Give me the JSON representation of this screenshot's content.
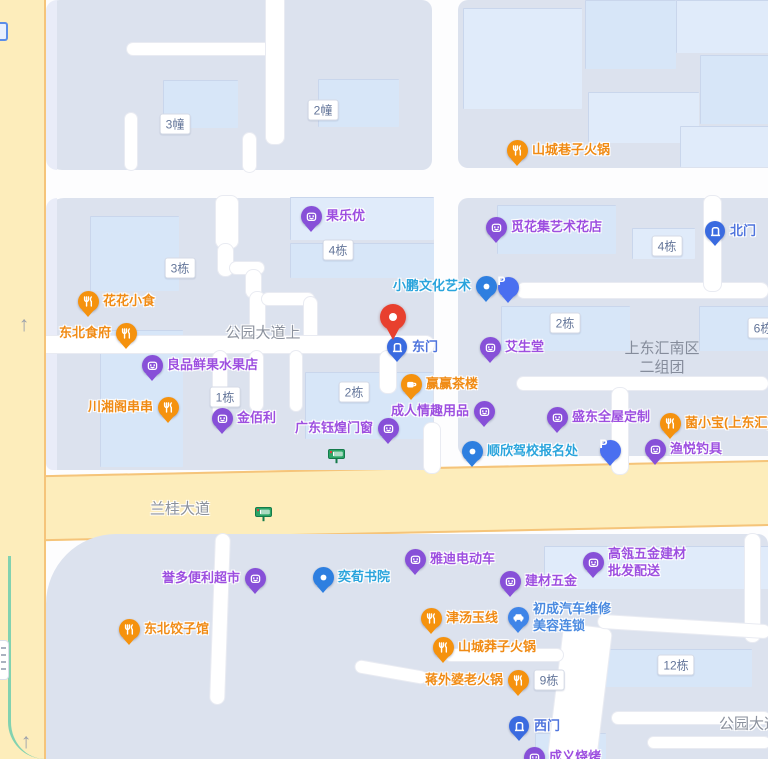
{
  "map": {
    "colors": {
      "poi_purple": "#8750d8",
      "poi_orange": "#f5920e",
      "poi_blue_dot": "#2e7fe0",
      "parking_blue": "#4a6ff0",
      "gate_blue": "#3a6be0",
      "selected_pin_red": "#e8402e",
      "road_yellow": "#fdedbb",
      "road_yellow_border": "#f5c47a",
      "block_gray": "#dce2ee",
      "building_blue": "#d7e6f8",
      "bus_stop_green": "#2ba567"
    },
    "pois": [
      {
        "id": "shancheng-xiangzi-hotpot",
        "type": "orange",
        "icon": "fork-knife-icon",
        "x": 517,
        "y": 150,
        "lines": [
          "山城巷子火锅"
        ],
        "side": "right",
        "lc": "orange"
      },
      {
        "id": "guoleyou",
        "type": "purple",
        "icon": "bag-icon",
        "x": 311,
        "y": 216,
        "lines": [
          "果乐优"
        ],
        "side": "right",
        "lc": "purple"
      },
      {
        "id": "mihuaji-art-flower-shop",
        "type": "purple",
        "icon": "bag-icon",
        "x": 496,
        "y": 227,
        "lines": [
          "觅花集艺术花店"
        ],
        "side": "right",
        "lc": "purple"
      },
      {
        "id": "north-gate",
        "type": "gate",
        "icon": "door-icon",
        "x": 715,
        "y": 231,
        "lines": [
          "北门"
        ],
        "side": "right",
        "lc": "gate"
      },
      {
        "id": "huahua-snack",
        "type": "orange",
        "icon": "fork-knife-icon",
        "x": 88,
        "y": 301,
        "lines": [
          "花花小食"
        ],
        "side": "right",
        "lc": "orange"
      },
      {
        "id": "dongbei-shifu",
        "type": "orange",
        "icon": "fork-knife-icon",
        "x": 126,
        "y": 333,
        "lines": [
          "东北食府"
        ],
        "side": "left",
        "lc": "orange"
      },
      {
        "id": "xiaopeng-culture-art",
        "type": "bluedot",
        "icon": "dot-icon",
        "x": 486,
        "y": 286,
        "lines": [
          "小鹏文化艺术"
        ],
        "side": "left",
        "lc": "cyan"
      },
      {
        "id": "parking-north",
        "type": "parking",
        "icon": "p-letter-icon",
        "x": 508,
        "y": 287,
        "lines": [],
        "side": "right",
        "lc": "purple"
      },
      {
        "id": "east-gate",
        "type": "gate",
        "icon": "door-icon",
        "x": 397,
        "y": 347,
        "lines": [
          "东门"
        ],
        "side": "right",
        "lc": "gate"
      },
      {
        "id": "aishengtang",
        "type": "purple",
        "icon": "bag-icon",
        "x": 490,
        "y": 347,
        "lines": [
          "艾生堂"
        ],
        "side": "right",
        "lc": "purple"
      },
      {
        "id": "liangpin-fresh-fruit",
        "type": "purple",
        "icon": "bag-icon",
        "x": 152,
        "y": 365,
        "lines": [
          "良品鲜果水果店"
        ],
        "side": "right",
        "lc": "purple"
      },
      {
        "id": "yingying-teahouse",
        "type": "orange",
        "icon": "coffee-icon",
        "x": 411,
        "y": 384,
        "lines": [
          "赢赢茶楼"
        ],
        "side": "right",
        "lc": "orange"
      },
      {
        "id": "chuanxiangge-chuanchuan",
        "type": "orange",
        "icon": "fork-knife-icon",
        "x": 168,
        "y": 407,
        "lines": [
          "川湘阁串串"
        ],
        "side": "left",
        "lc": "orange"
      },
      {
        "id": "jinbaili",
        "type": "purple",
        "icon": "bag-icon",
        "x": 222,
        "y": 418,
        "lines": [
          "金佰利"
        ],
        "side": "right",
        "lc": "purple"
      },
      {
        "id": "guangdong-yuhuang-doors",
        "type": "purple",
        "icon": "bag-icon",
        "x": 388,
        "y": 428,
        "lines": [
          "广东钰煌门窗"
        ],
        "side": "left",
        "lc": "purple"
      },
      {
        "id": "adult-products-shop",
        "type": "purple",
        "icon": "bag-icon",
        "x": 484,
        "y": 411,
        "lines": [
          "成人情趣用品"
        ],
        "side": "left",
        "lc": "purple"
      },
      {
        "id": "shengdong-whole-house-custom",
        "type": "purple",
        "icon": "bag-icon",
        "x": 557,
        "y": 417,
        "lines": [
          "盛东全屋定制"
        ],
        "side": "right",
        "lc": "purple"
      },
      {
        "id": "junxiaobao-shangdonghui",
        "type": "orange",
        "icon": "fork-knife-icon",
        "x": 670,
        "y": 423,
        "lines": [
          "菌小宝(上东汇)"
        ],
        "side": "right",
        "lc": "orange"
      },
      {
        "id": "shunxin-driving-school",
        "type": "bluedot",
        "icon": "dot-icon",
        "x": 472,
        "y": 451,
        "lines": [
          "顺欣驾校报名处"
        ],
        "side": "right",
        "lc": "cyan"
      },
      {
        "id": "parking-south",
        "type": "parking",
        "icon": "p-letter-icon",
        "x": 610,
        "y": 450,
        "lines": [],
        "side": "right",
        "lc": "purple"
      },
      {
        "id": "yuyue-fishing-gear",
        "type": "purple",
        "icon": "bag-icon",
        "x": 655,
        "y": 449,
        "lines": [
          "渔悦钓具"
        ],
        "side": "right",
        "lc": "purple"
      },
      {
        "id": "yuduo-convenience-store",
        "type": "purple",
        "icon": "bag-icon",
        "x": 255,
        "y": 578,
        "lines": [
          "誉多便利超市"
        ],
        "side": "left",
        "lc": "purple"
      },
      {
        "id": "yixun-academy",
        "type": "bluedot",
        "icon": "dot-icon",
        "x": 323,
        "y": 577,
        "lines": [
          "奕荀书院"
        ],
        "side": "right",
        "lc": "cyan"
      },
      {
        "id": "yadi-ebike",
        "type": "purple",
        "icon": "bag-icon",
        "x": 415,
        "y": 559,
        "lines": [
          "雅迪电动车"
        ],
        "side": "right",
        "lc": "purple"
      },
      {
        "id": "gaoling-hardware-wholesale",
        "type": "purple",
        "icon": "bag-icon",
        "x": 593,
        "y": 562,
        "lines": [
          "高瓴五金建材",
          "批发配送"
        ],
        "side": "right",
        "lc": "purple"
      },
      {
        "id": "jiancai-wujin",
        "type": "purple",
        "icon": "bag-icon",
        "x": 510,
        "y": 581,
        "lines": [
          "建材五金"
        ],
        "side": "right",
        "lc": "purple"
      },
      {
        "id": "dongbei-dumpling-house",
        "type": "orange",
        "icon": "fork-knife-icon",
        "x": 129,
        "y": 629,
        "lines": [
          "东北饺子馆"
        ],
        "side": "right",
        "lc": "orange"
      },
      {
        "id": "jintang-yuxian",
        "type": "orange",
        "icon": "fork-knife-icon",
        "x": 431,
        "y": 618,
        "lines": [
          "津汤玉线"
        ],
        "side": "right",
        "lc": "orange"
      },
      {
        "id": "chucheng-auto-repair",
        "type": "bluecar",
        "icon": "car-icon",
        "x": 518,
        "y": 617,
        "lines": [
          "初成汽车维修",
          "美容连锁"
        ],
        "side": "right",
        "lc": "blue"
      },
      {
        "id": "shancheng-mangzi-hotpot",
        "type": "orange",
        "icon": "fork-knife-icon",
        "x": 443,
        "y": 647,
        "lines": [
          "山城莽子火锅"
        ],
        "side": "right",
        "lc": "orange"
      },
      {
        "id": "jiangwaipo-hotpot",
        "type": "orange",
        "icon": "fork-knife-icon",
        "x": 518,
        "y": 680,
        "lines": [
          "蒋外婆老火锅"
        ],
        "side": "left",
        "lc": "orange"
      },
      {
        "id": "west-gate",
        "type": "gate",
        "icon": "door-icon",
        "x": 519,
        "y": 726,
        "lines": [
          "西门"
        ],
        "side": "right",
        "lc": "gate"
      },
      {
        "id": "chengyi-bbq",
        "type": "purple",
        "icon": "bag-icon",
        "x": 534,
        "y": 757,
        "lines": [
          "成义烧烤"
        ],
        "side": "right",
        "lc": "purple"
      }
    ],
    "selected_pin": {
      "x": 393,
      "y": 317
    },
    "building_labels": [
      {
        "text": "3幢",
        "x": 175,
        "y": 124
      },
      {
        "text": "2幢",
        "x": 323,
        "y": 110
      },
      {
        "text": "3栋",
        "x": 180,
        "y": 268
      },
      {
        "text": "4栋",
        "x": 338,
        "y": 250
      },
      {
        "text": "4栋",
        "x": 667,
        "y": 246
      },
      {
        "text": "2栋",
        "x": 565,
        "y": 323
      },
      {
        "text": "6栋",
        "x": 763,
        "y": 328
      },
      {
        "text": "1栋",
        "x": 225,
        "y": 397
      },
      {
        "text": "2栋",
        "x": 354,
        "y": 392
      },
      {
        "text": "9栋",
        "x": 549,
        "y": 680
      },
      {
        "text": "12栋",
        "x": 676,
        "y": 665
      }
    ],
    "road_labels": [
      {
        "text": "公园大道上",
        "x": 263,
        "y": 332,
        "size": 15
      },
      {
        "text": "兰桂大道",
        "x": 180,
        "y": 508,
        "size": 15
      },
      {
        "text": "公园大道",
        "x": 749,
        "y": 723,
        "size": 15
      }
    ],
    "area_label": {
      "lines": [
        "上东汇南区",
        "二组团"
      ],
      "x": 662,
      "y": 358
    },
    "bus_stops": [
      {
        "id": "bus-stop-1",
        "x": 337,
        "y": 459
      },
      {
        "id": "bus-stop-2",
        "x": 264,
        "y": 517
      }
    ],
    "road_arrows": [
      {
        "x": 24,
        "y": 325
      },
      {
        "x": 26,
        "y": 742
      }
    ]
  }
}
